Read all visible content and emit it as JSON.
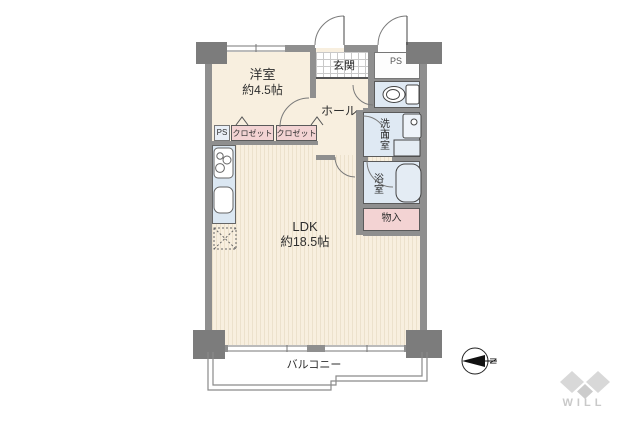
{
  "rooms": {
    "yoshitsu": {
      "label": "洋室",
      "area": "約4.5帖"
    },
    "ldk": {
      "label": "LDK",
      "area": "約18.5帖"
    },
    "genkan": {
      "label": "玄関"
    },
    "hall": {
      "label": "ホール"
    },
    "senmen": {
      "label": "洗面室"
    },
    "bath": {
      "label": "浴室"
    },
    "monoire": {
      "label": "物入"
    },
    "ps_top": {
      "label": "PS"
    },
    "ps_small": {
      "label": "PS"
    },
    "closet_1": {
      "label": "クロゼット"
    },
    "closet_2": {
      "label": "クロゼット"
    },
    "balcony": {
      "label": "バルコニー"
    }
  },
  "compass": {
    "north": "N"
  },
  "logo": {
    "brand": "WILL"
  },
  "colors": {
    "wall": "#8f8f8f",
    "floor": "#f8efdf",
    "water_room": "#dfe9f3",
    "closet": "#f3d3d3",
    "logo_gray": "#d8d8d8"
  }
}
